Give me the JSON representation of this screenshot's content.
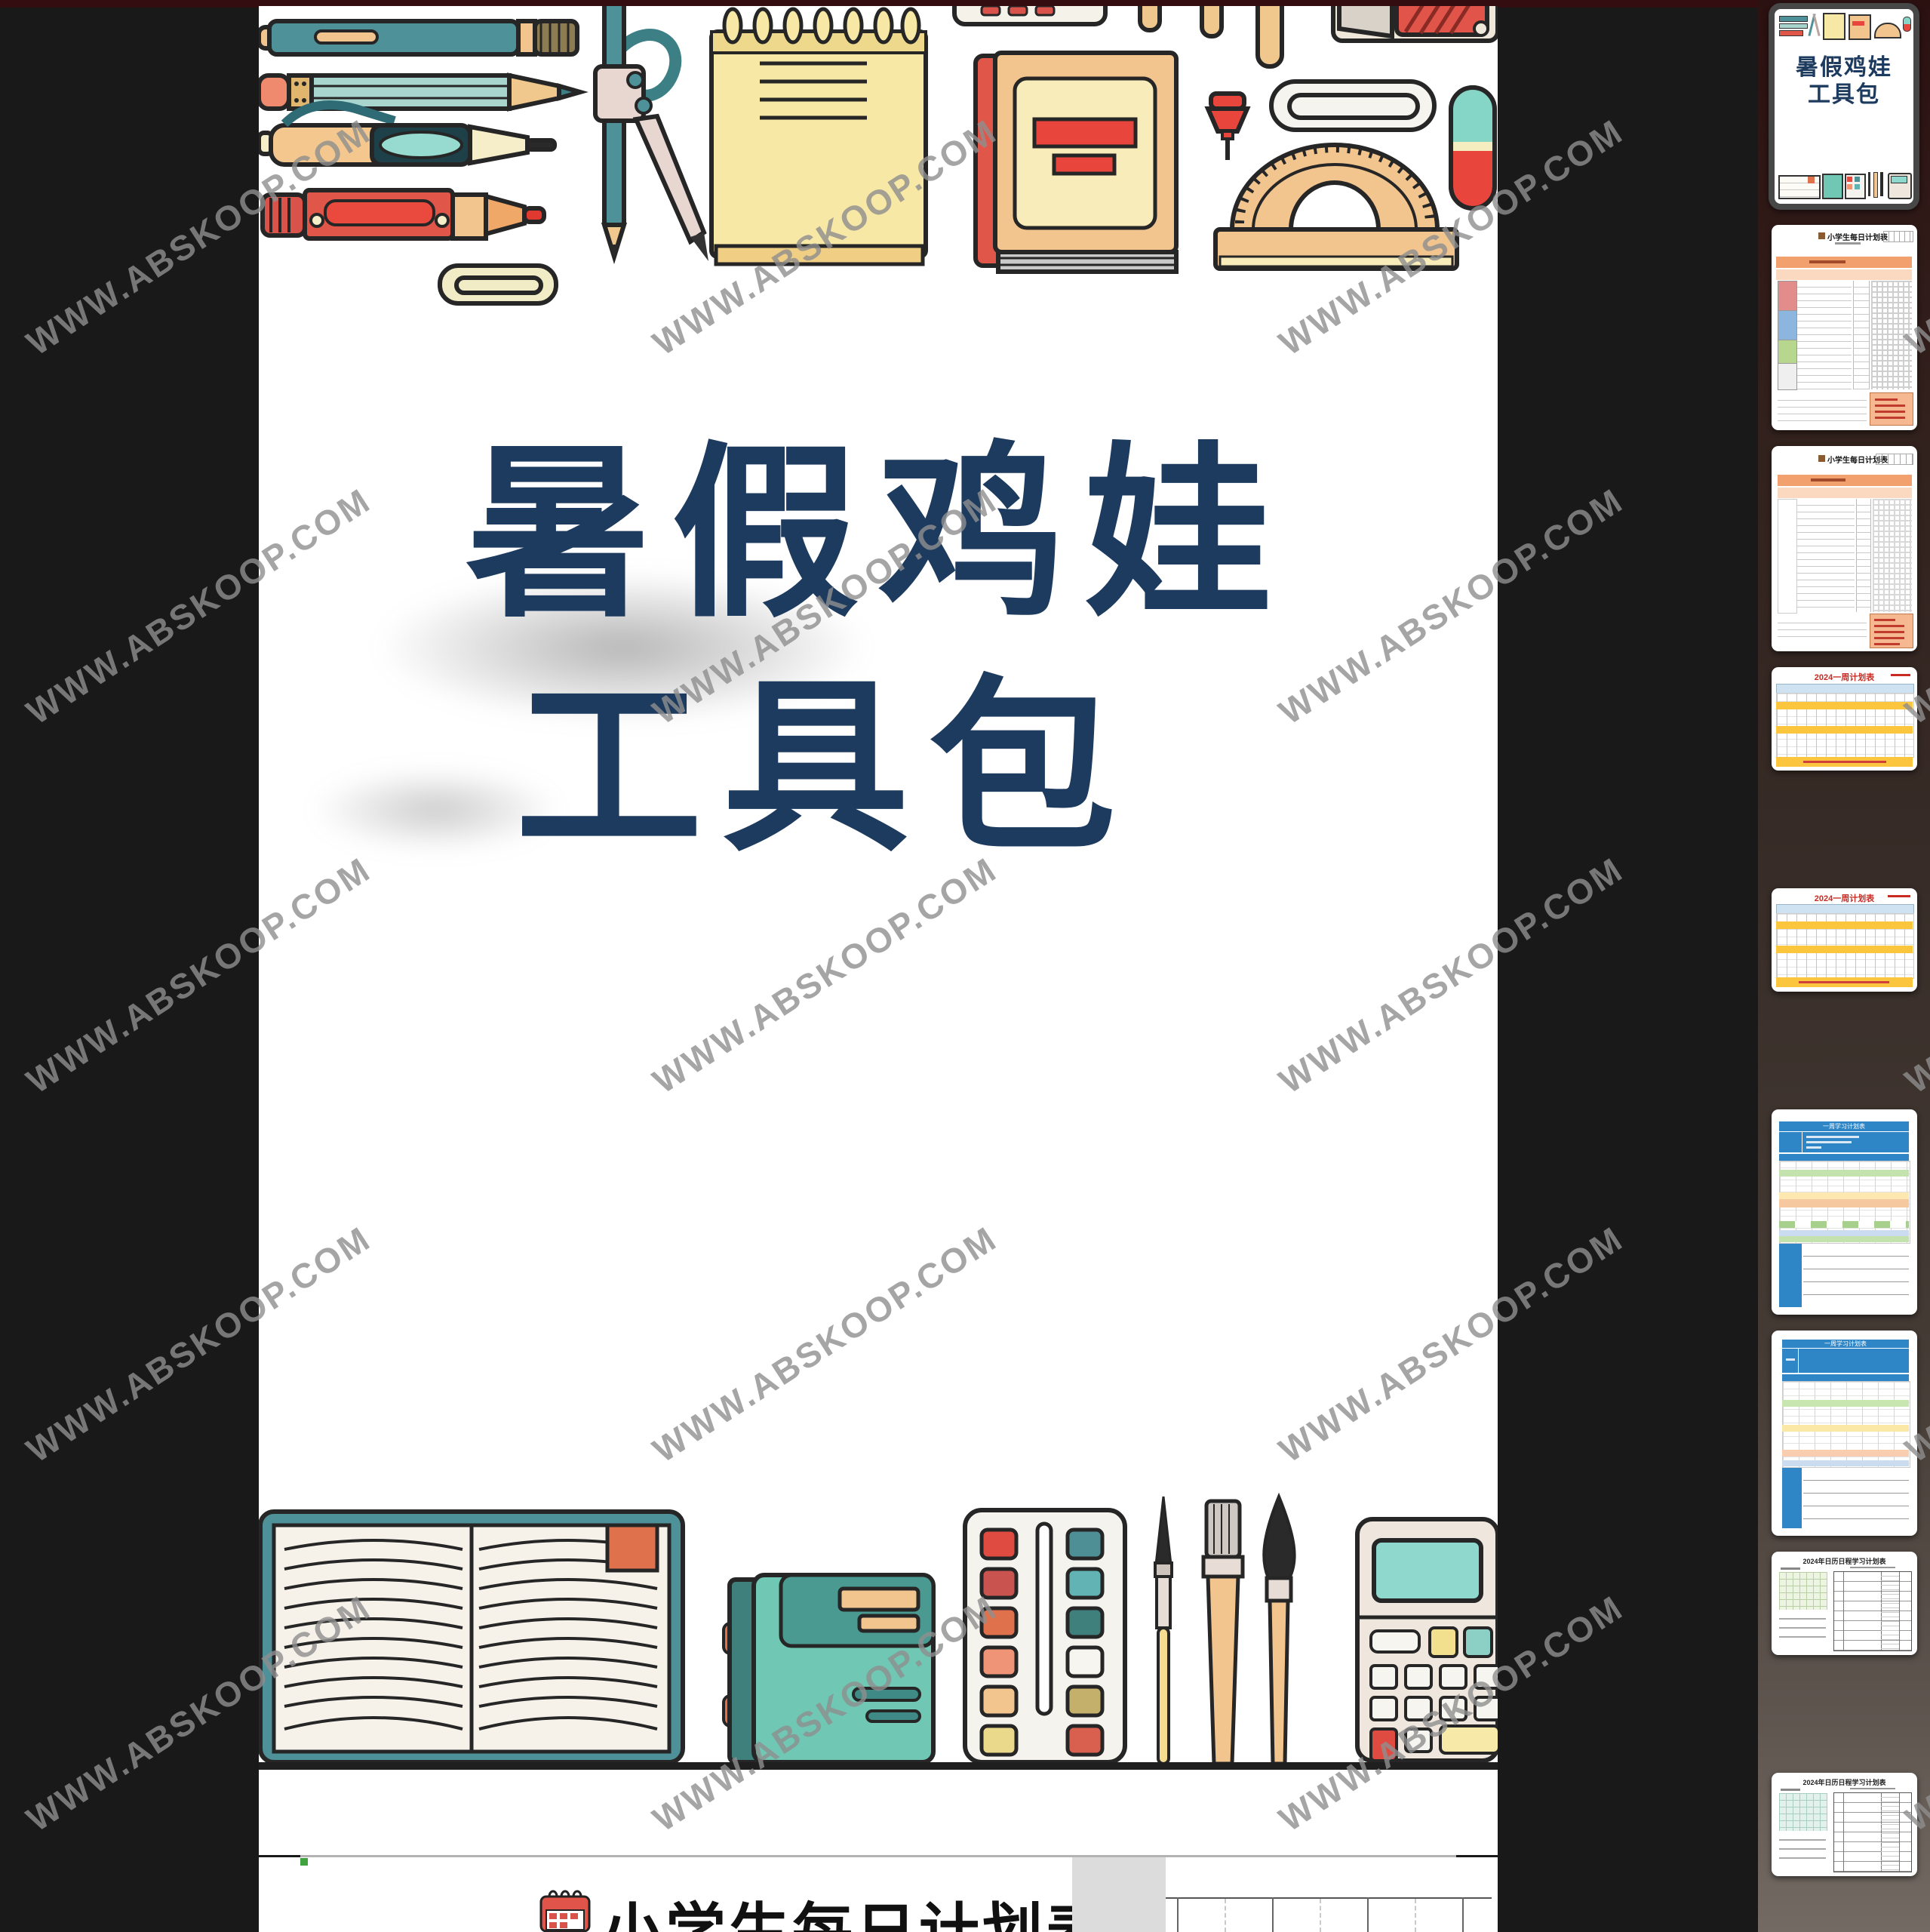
{
  "watermark": {
    "text": "WWW.ABSKOOP.COM"
  },
  "viewer": {
    "cover": {
      "title_line1": "暑假鸡娃",
      "title_line2": "工具包"
    },
    "page2": {
      "title": "小学生每日计划表"
    }
  },
  "sidebar": {
    "thumbnails": [
      {
        "label": "暑假鸡娃工具包",
        "title_line1": "暑假鸡娃",
        "title_line2": "工具包",
        "selected": true
      },
      {
        "label": "小学生每日计划表",
        "selected": false
      },
      {
        "label": "小学生每日计划表",
        "selected": false
      },
      {
        "label": "2024一周计划表",
        "selected": false
      },
      {
        "label": "2024一周计划表",
        "selected": false
      },
      {
        "label": "一周学习计划表",
        "selected": false
      },
      {
        "label": "一周学习计划表",
        "selected": false
      },
      {
        "label": "2024年日历日程学习计划表",
        "selected": false
      },
      {
        "label": "2024年日历日程学习计划表",
        "selected": false
      }
    ]
  },
  "illustrations": {
    "top_band": [
      "teal-pen",
      "pencil",
      "ballpoint-pen",
      "red-marker",
      "paperclip",
      "drawing-compass",
      "spiral-notepad",
      "eraser",
      "wooden-sticks",
      "pencil-sharpener",
      "red-book",
      "pushpin",
      "large-paperclip",
      "protractor",
      "capsule-eraser"
    ],
    "bottom_band": [
      "open-book",
      "teal-notebook",
      "watercolor-palette",
      "paint-brushes",
      "calculator"
    ]
  },
  "colors": {
    "title_navy": "#1d3a5f",
    "top_bar_maroon": "#330d10",
    "background": "#191919",
    "selected_thumb_border": "#474747",
    "table_blue": "#2e86c7",
    "band_yellow": "#fbc63e",
    "band_orange": "#f2a06e",
    "week_title_red": "#c92a22"
  }
}
